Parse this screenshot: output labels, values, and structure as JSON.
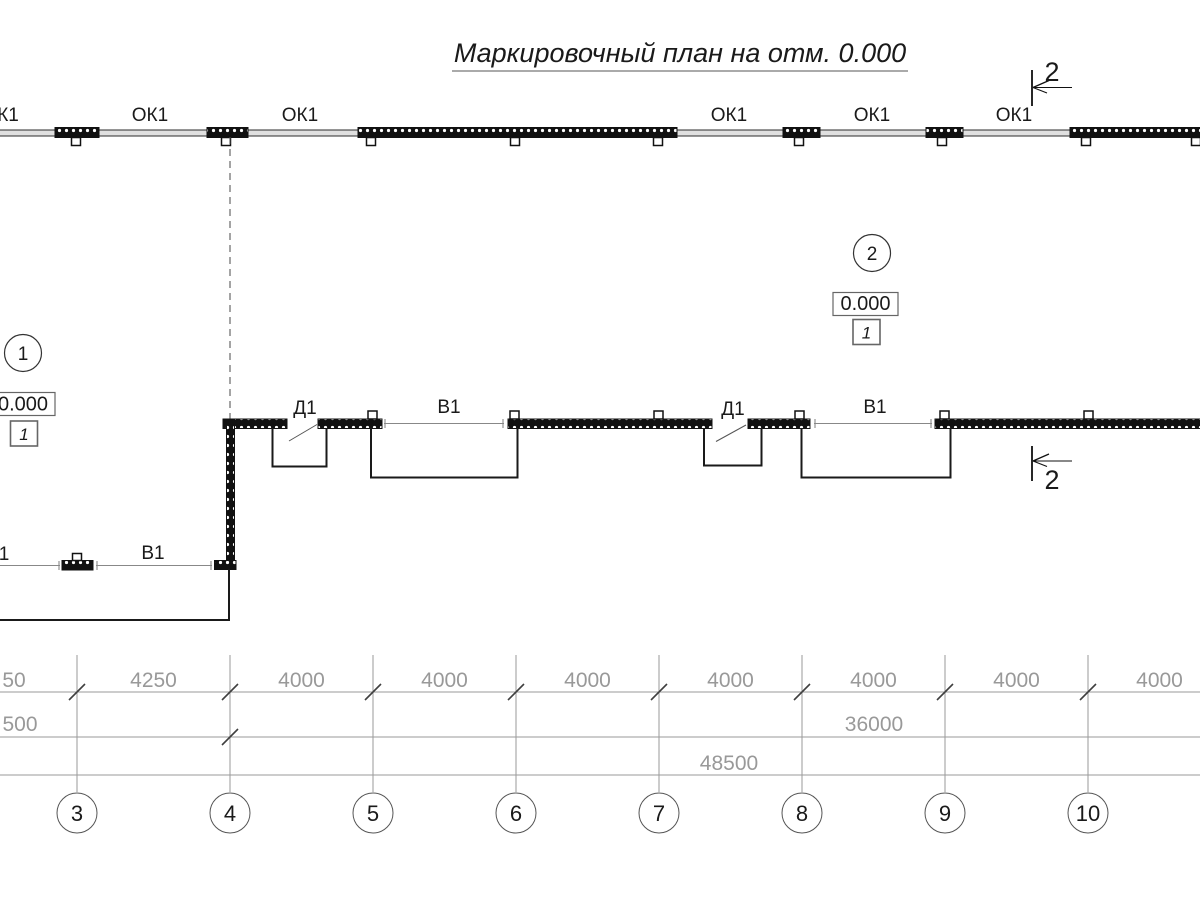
{
  "title": "Маркировочный план на отм. 0.000",
  "labels": {
    "windows": [
      "К1",
      "ОК1",
      "ОК1",
      "ОК1",
      "ОК1",
      "ОК1"
    ],
    "doors": [
      "Д1",
      "Д1"
    ],
    "openings": [
      "В1",
      "В1"
    ],
    "openings_bottom": [
      "1",
      "В1"
    ]
  },
  "section_mark": {
    "top": "2",
    "bottom": "2"
  },
  "nodes": [
    {
      "number": "1",
      "elevation": "0.000",
      "frame": "1"
    },
    {
      "number": "2",
      "elevation": "0.000",
      "frame": "1"
    }
  ],
  "dimensions": {
    "row1": [
      "50",
      "4250",
      "4000",
      "4000",
      "4000",
      "4000",
      "4000",
      "4000",
      "4000"
    ],
    "row2": [
      "500",
      "36000"
    ],
    "row3": [
      "48500"
    ]
  },
  "axes": [
    "3",
    "4",
    "5",
    "6",
    "7",
    "8",
    "9",
    "10"
  ],
  "colors": {
    "ink": "#1a1a1a",
    "dim_gray": "#999999",
    "wall_fill": "#e0e0e0"
  }
}
